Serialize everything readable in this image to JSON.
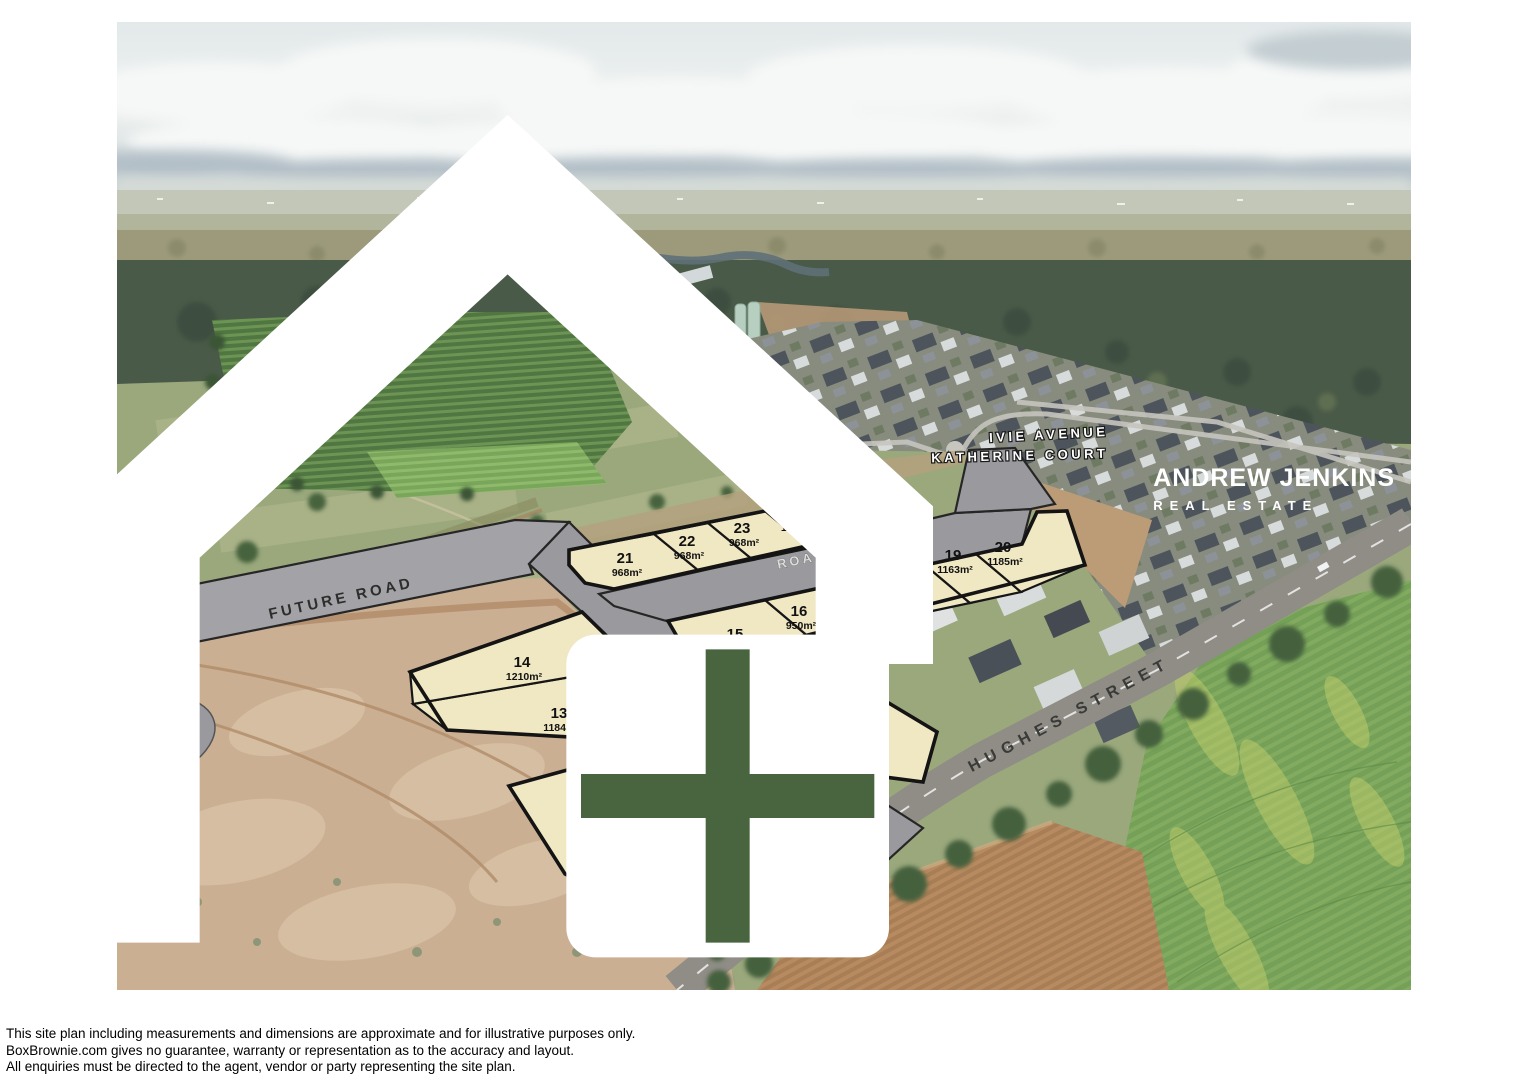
{
  "plan": {
    "lots": [
      {
        "num": "10",
        "area": "950m²"
      },
      {
        "num": "11",
        "area": "916m²"
      },
      {
        "num": "12",
        "area": "915m²"
      },
      {
        "num": "13",
        "area": "1184m²"
      },
      {
        "num": "14",
        "area": "1210m²"
      },
      {
        "num": "15",
        "area": "950m²"
      },
      {
        "num": "16",
        "area": "950m²"
      },
      {
        "num": "17",
        "area": "950m²"
      },
      {
        "num": "18",
        "area": "950m²"
      },
      {
        "num": "19",
        "area": "1163m²"
      },
      {
        "num": "20",
        "area": "1185m²"
      },
      {
        "num": "21",
        "area": "968m²"
      },
      {
        "num": "22",
        "area": "968m²"
      },
      {
        "num": "23",
        "area": "968m²"
      },
      {
        "num": "24",
        "area": "1063m²"
      },
      {
        "num": "25",
        "area": "1063m²"
      },
      {
        "num": "26",
        "area": "1065m²"
      }
    ],
    "roads": {
      "future": "FUTURE ROAD",
      "road1": "ROAD 1",
      "road2": "ROAD 2"
    },
    "streets": {
      "hughes": "HUGHES STREET",
      "ivie": "IVIE AVENUE",
      "katherine": "KATHERINE COURT"
    }
  },
  "logo": {
    "brand": "ANDREW JENKINS",
    "tagline": "REAL ESTATE"
  },
  "disclaimer_lines": [
    "This site plan including measurements and dimensions are approximate and for illustrative purposes only.",
    "BoxBrownie.com gives no guarantee, warranty or representation as to the accuracy and layout.",
    "All enquiries must be directed to the agent, vendor or party representing the site plan."
  ],
  "colors": {
    "lot_fill": "#f0e7c3",
    "lot_stroke": "#161616",
    "road_fill": "#9a999d",
    "label_ink": "#111111"
  }
}
